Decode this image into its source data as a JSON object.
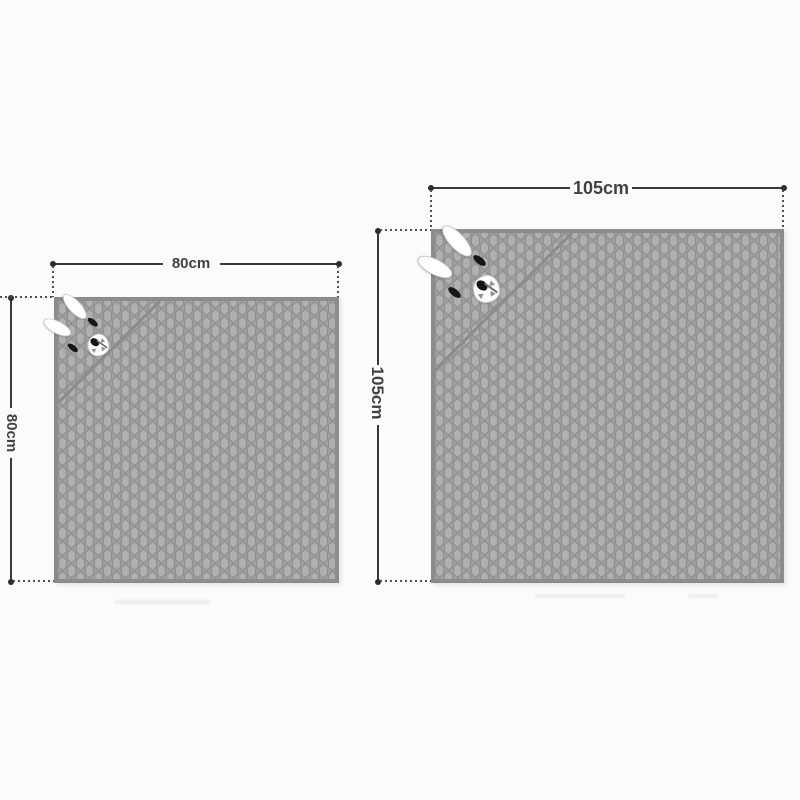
{
  "background": "#fbfbfb",
  "blankets": [
    {
      "name": "small-hooded-blanket",
      "width_label": "80cm",
      "height_label": "80cm"
    },
    {
      "name": "large-hooded-blanket",
      "width_label": "105cm",
      "height_label": "105cm"
    }
  ],
  "colors": {
    "fabric_fill": "#b0b0b0",
    "fabric_outline": "#8f8f8f",
    "edge_binding": "#8c8c8c",
    "dimension_line": "#383838",
    "label_text": "#414141"
  }
}
